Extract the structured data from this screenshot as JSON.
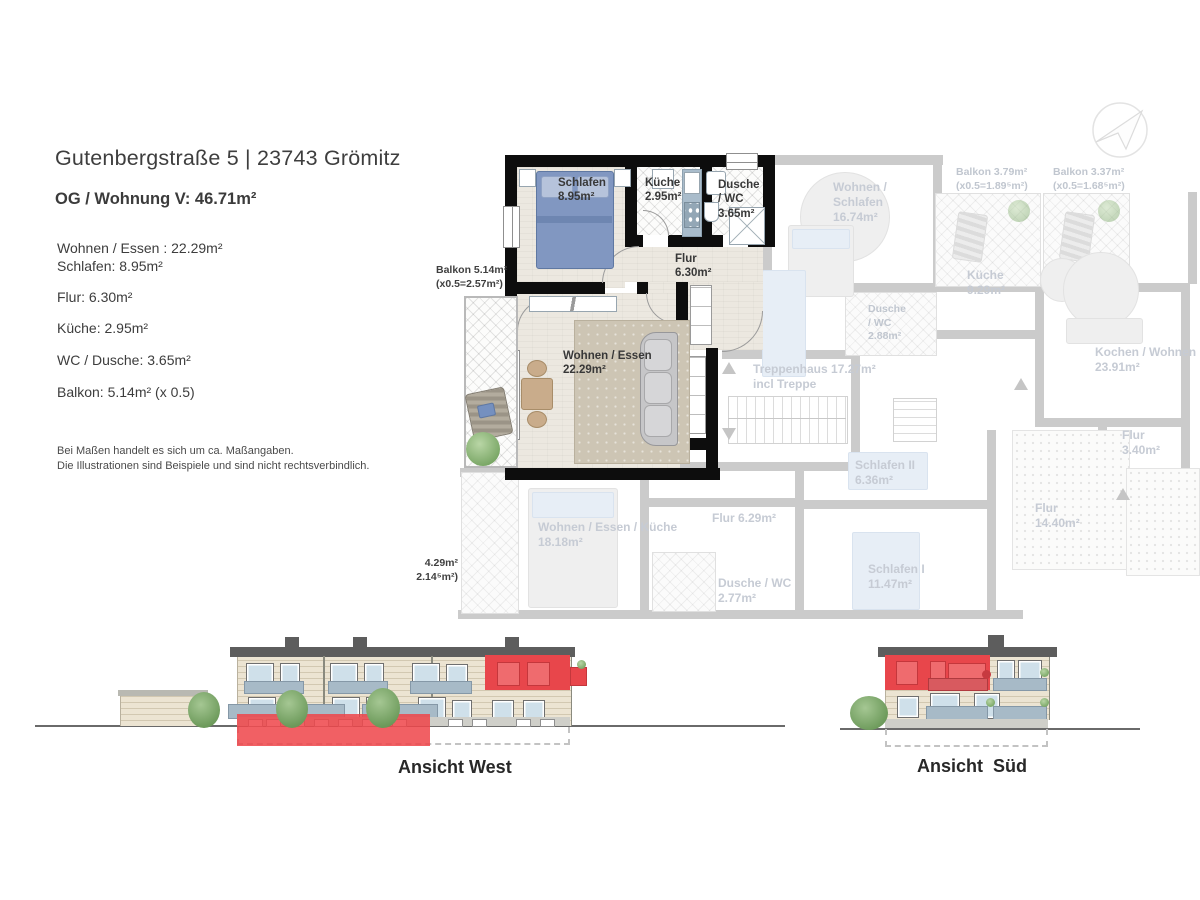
{
  "header": {
    "title": "Gutenbergstraße 5 | 23743 Grömitz",
    "subtitle": "OG / Wohnung V: 46.71m²"
  },
  "room_list": [
    "Wohnen / Essen : 22.29m²",
    "Schlafen: 8.95m²",
    "Flur: 6.30m²",
    "Küche: 2.95m²",
    "WC / Dusche: 3.65m²",
    "Balkon: 5.14m² (x 0.5)"
  ],
  "disclaimer": "Bei Maßen handelt es sich um ca. Maßangaben.\nDie Illustrationen sind Beispiele und sind nicht rechtsverbindlich.",
  "plan": {
    "apartment_labels": {
      "schlafen": "Schlafen\n8.95m²",
      "kueche": "Küche\n2.95m²",
      "dusche_wc": "Dusche\n/ WC\n3.65m²",
      "flur": "Flur\n6.30m²",
      "wohnen_essen": "Wohnen / Essen\n22.29m²",
      "balkon": "Balkon 5.14m²\n(x0.5=2.57m²)"
    },
    "context_labels": {
      "wohnen_schlafen": "Wohnen /\nSchlafen\n16.74m²",
      "balkon_a": "Balkon 3.79m²\n(x0.5=1.89⁵m²)",
      "balkon_b": "Balkon 3.37m²\n(x0.5=1.68⁵m²)",
      "kueche": "Küche\n9.29m²",
      "dusche_wc": "Dusche\n/ WC\n2.88m²",
      "treppenhaus": "Treppenhaus 17.27m²\nincl Treppe",
      "kochen_wohnen": "Kochen / Wohnen\n23.91m²",
      "flur_a": "Flur\n3.40m²",
      "schlafen_2": "Schlafen II\n6.36m²",
      "flur_b": "Flur 6.29m²",
      "flur_c": "Flur\n14.40m²",
      "wohnen_essen_kueche": "Wohnen / Essen / Küche\n18.18m²",
      "dusche_wc_b": "Dusche / WC\n2.77m²",
      "schlafen_1": "Schlafen I\n11.47m²",
      "balkon_c": "4.29m²\n2.14⁵m²)"
    }
  },
  "elevations": {
    "west": "Ansicht West",
    "sued": "Ansicht  Süd"
  },
  "icons": {
    "north_arrow": "north-arrow-icon"
  },
  "colors": {
    "highlight_red": "#e8464b",
    "wall_black": "#0d0d0d",
    "faded_gray": "#cbcbcb",
    "faded_text": "#c6cbd4",
    "bed_blue": "#8197c1",
    "counter_blue": "#a9bccb"
  }
}
